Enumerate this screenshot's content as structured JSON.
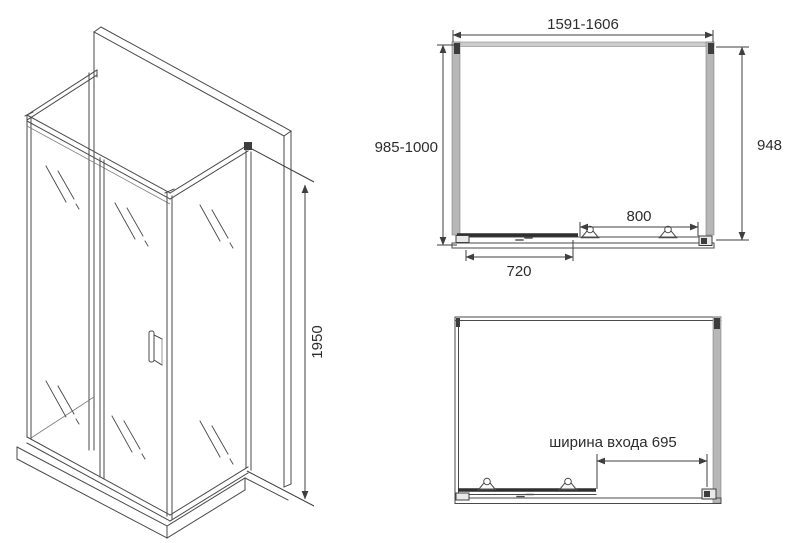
{
  "drawing": {
    "title": "Shower enclosure technical drawing",
    "colors": {
      "line": "#4a4a4a",
      "dimension_line": "#3f3f3f",
      "profile_gray": "#b7b7b7",
      "profile_band": "#cccccc",
      "text": "#2d2d2d",
      "background": "#ffffff"
    },
    "isometric_view": {
      "height": "1950"
    },
    "plan_view_closed": {
      "overall_width": "1591-1606",
      "depth_range": "985-1000",
      "side_panel_depth": "948",
      "fixed_section_width": "800",
      "door_width": "720"
    },
    "plan_view_open": {
      "entrance_width": "ширина входа 695"
    }
  }
}
